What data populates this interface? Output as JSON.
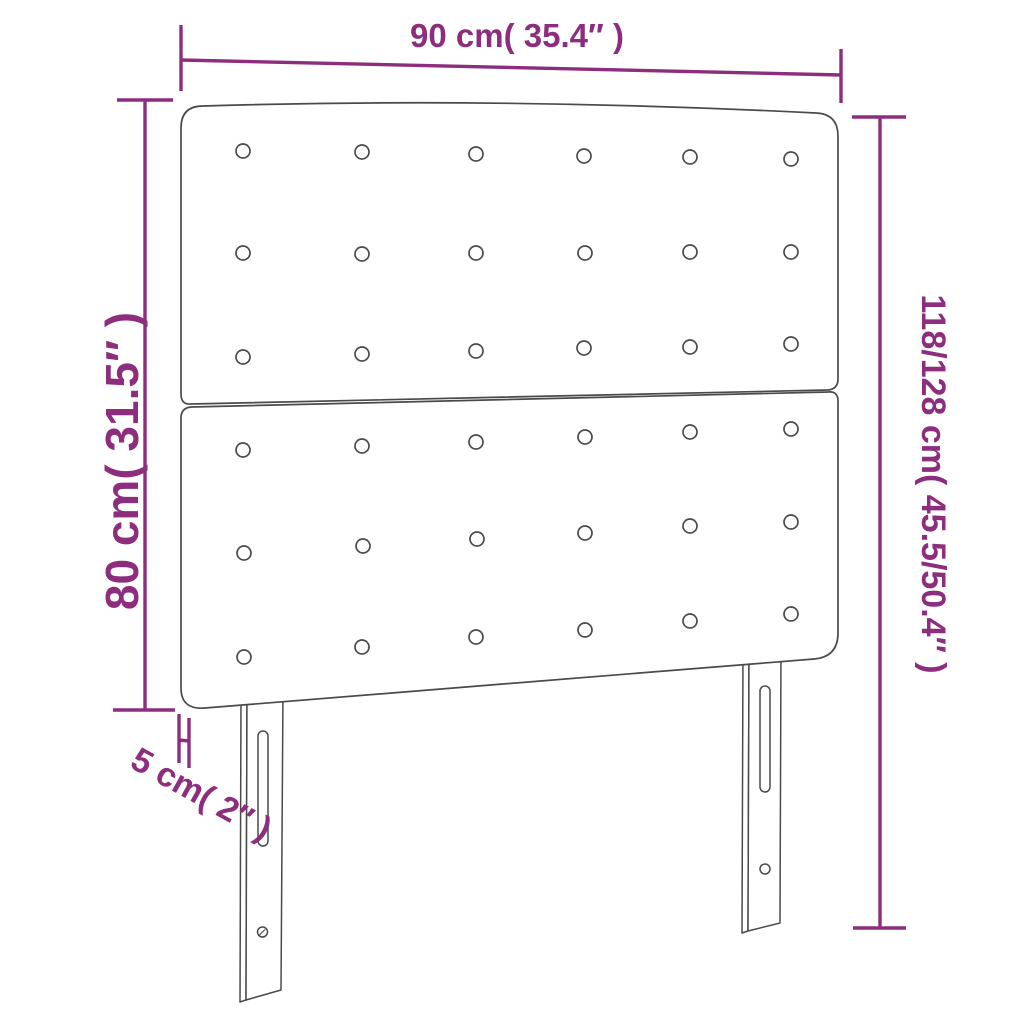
{
  "diagram": {
    "type": "product-dimension-diagram",
    "product": "upholstered headboard with two panels and two legs",
    "labels": {
      "width": "90 cm( 35.4″ )",
      "total_height": "118/128 cm( 45.5/50.4″ )",
      "board_height": "80 cm( 31.5″ )",
      "thickness": "5 cm( 2″ )"
    },
    "colors": {
      "dimension": "#8d2d7e",
      "outline": "#4a4a4a",
      "background": "#ffffff"
    },
    "button_grid": {
      "panels": 2,
      "rows_per_panel": 3,
      "columns": 6,
      "total_buttons": 36
    },
    "legs": {
      "count": 2,
      "slot_per_leg": 1,
      "hole_per_leg": 1
    }
  }
}
